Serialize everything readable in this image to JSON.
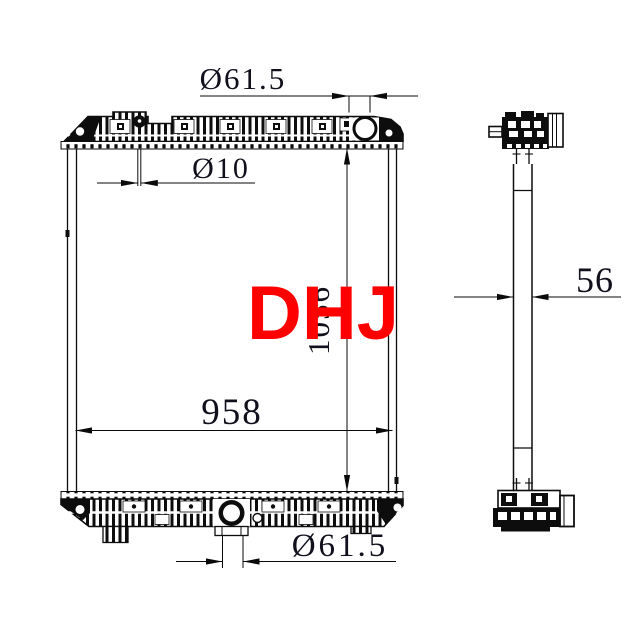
{
  "watermark": {
    "text": "DHJ",
    "color": "#ff0000"
  },
  "front_view": {
    "title": "radiator front view",
    "top_port_diameter": "Ø61.5",
    "inlet_pipe_diameter": "Ø10",
    "core_height": "1056",
    "core_width": "958",
    "bottom_port_diameter": "Ø61.5"
  },
  "side_view": {
    "title": "radiator side view",
    "thickness": "56"
  },
  "colors": {
    "line": "#0d0d0d",
    "dim_text": "#10101c",
    "background": "#ffffff",
    "watermark": "#ff0000"
  }
}
